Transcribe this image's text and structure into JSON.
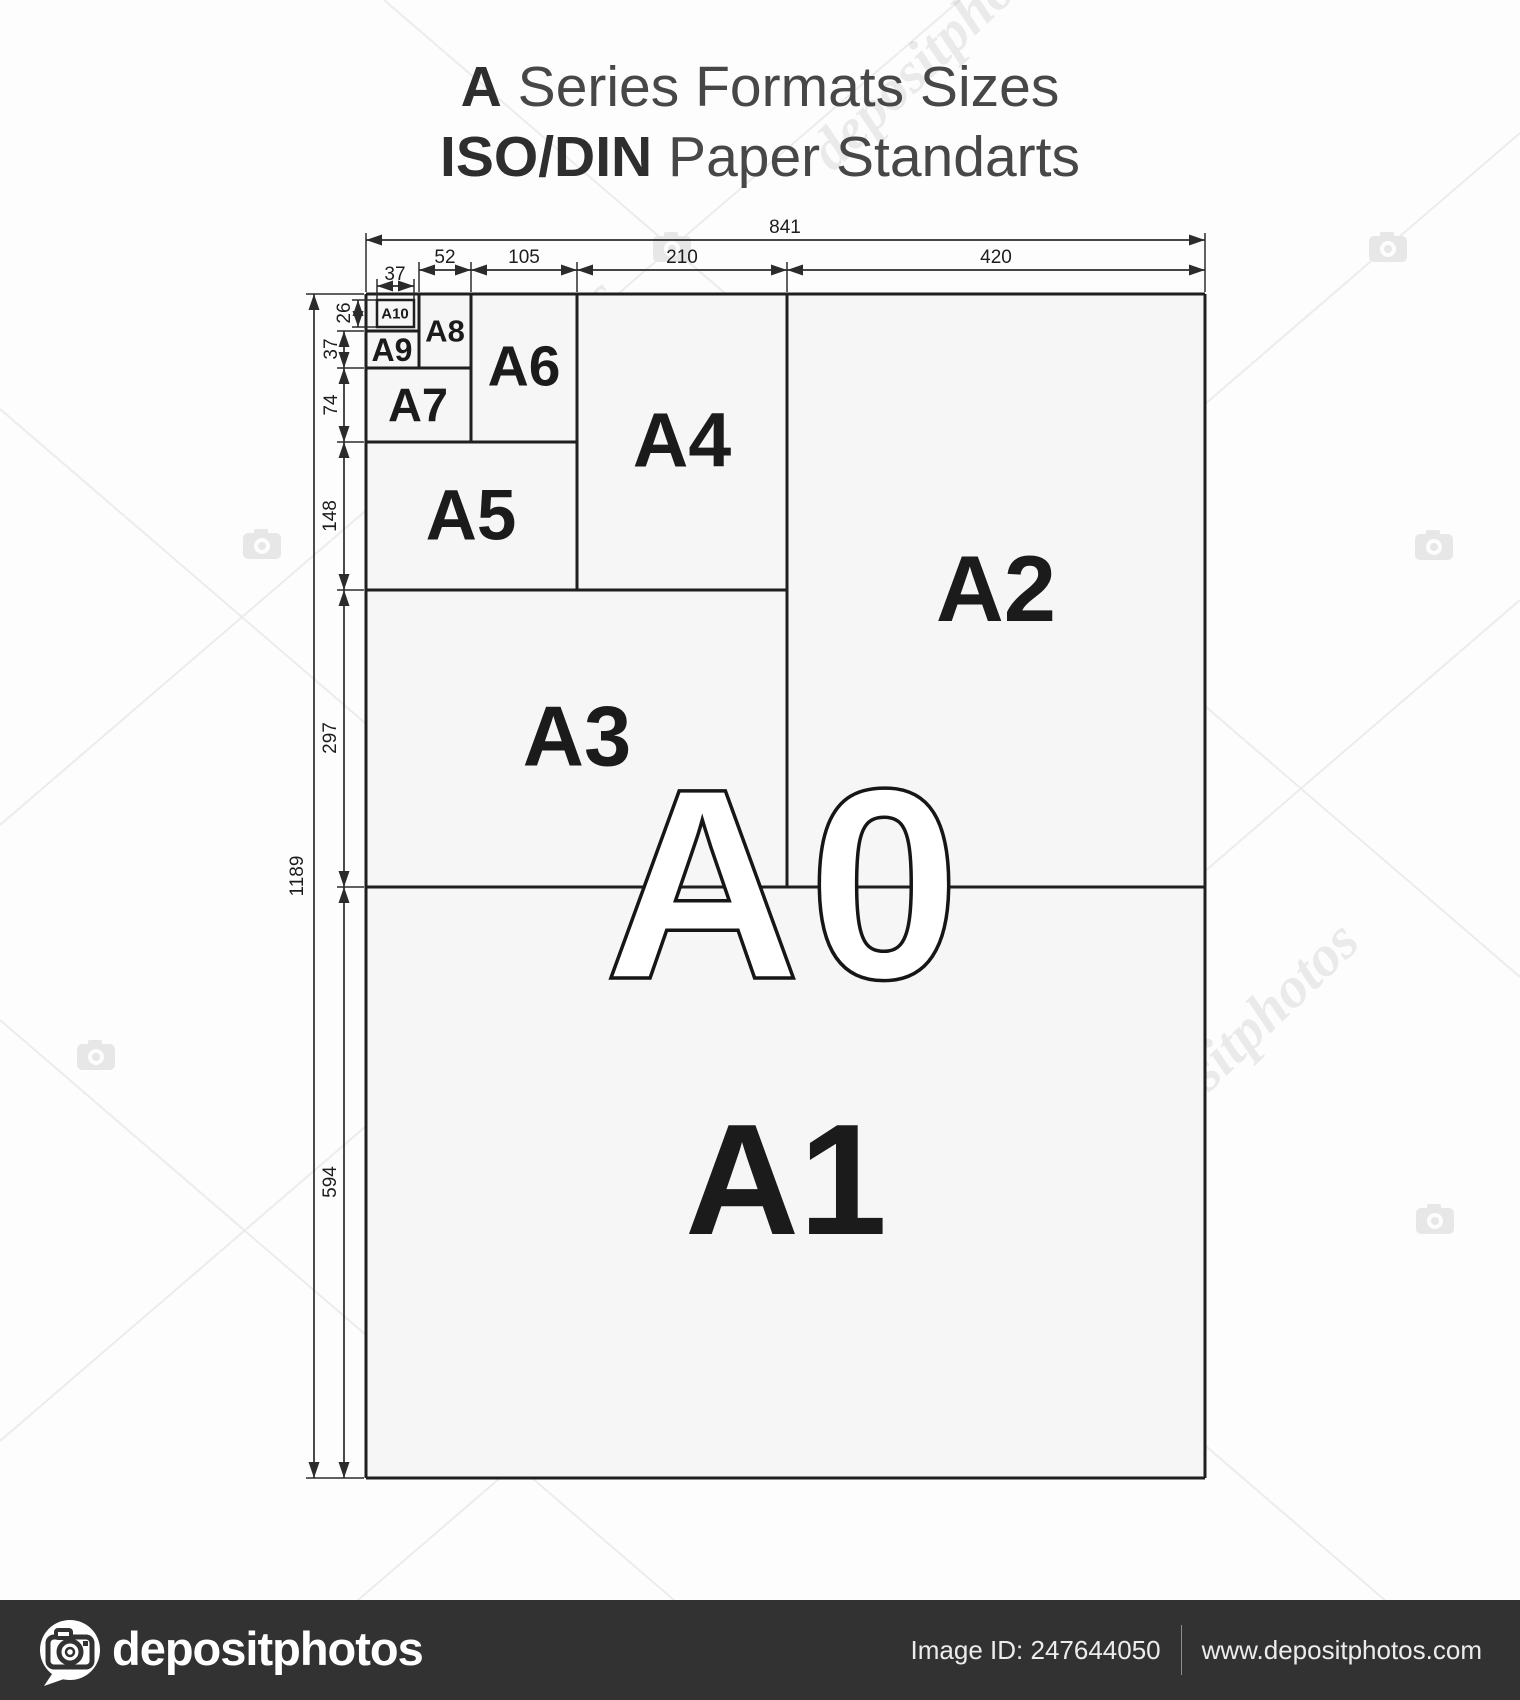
{
  "title": {
    "line1_bold": "A",
    "line1_rest": " Series Formats Sizes",
    "line2_bold": "ISO/DIN",
    "line2_rest": " Paper Standarts"
  },
  "diagram": {
    "formats": {
      "a0": "A0",
      "a1": "A1",
      "a2": "A2",
      "a3": "A3",
      "a4": "A4",
      "a5": "A5",
      "a6": "A6",
      "a7": "A7",
      "a8": "A8",
      "a9": "A9",
      "a10": "A10"
    },
    "dims_top": {
      "total": "841",
      "a10_width": "37",
      "a8_width": "52",
      "a6_width": "105",
      "a4_width": "210",
      "a2_width": "420"
    },
    "dims_left": {
      "total": "1189",
      "a10_height": "26",
      "a9_height": "37",
      "a7_height": "74",
      "a5_height": "148",
      "a3_height": "297",
      "a1_height": "594"
    }
  },
  "watermark": {
    "text": "depositphotos"
  },
  "footer": {
    "logo_text": "depositphotos",
    "image_id": "Image ID: 247644050",
    "website": "www.depositphotos.com"
  },
  "colors": {
    "line": "#1f1f1f",
    "sheet_fill": "#f6f6f6",
    "footer_bar": "#323232",
    "watermark_gray": "#ececec"
  }
}
